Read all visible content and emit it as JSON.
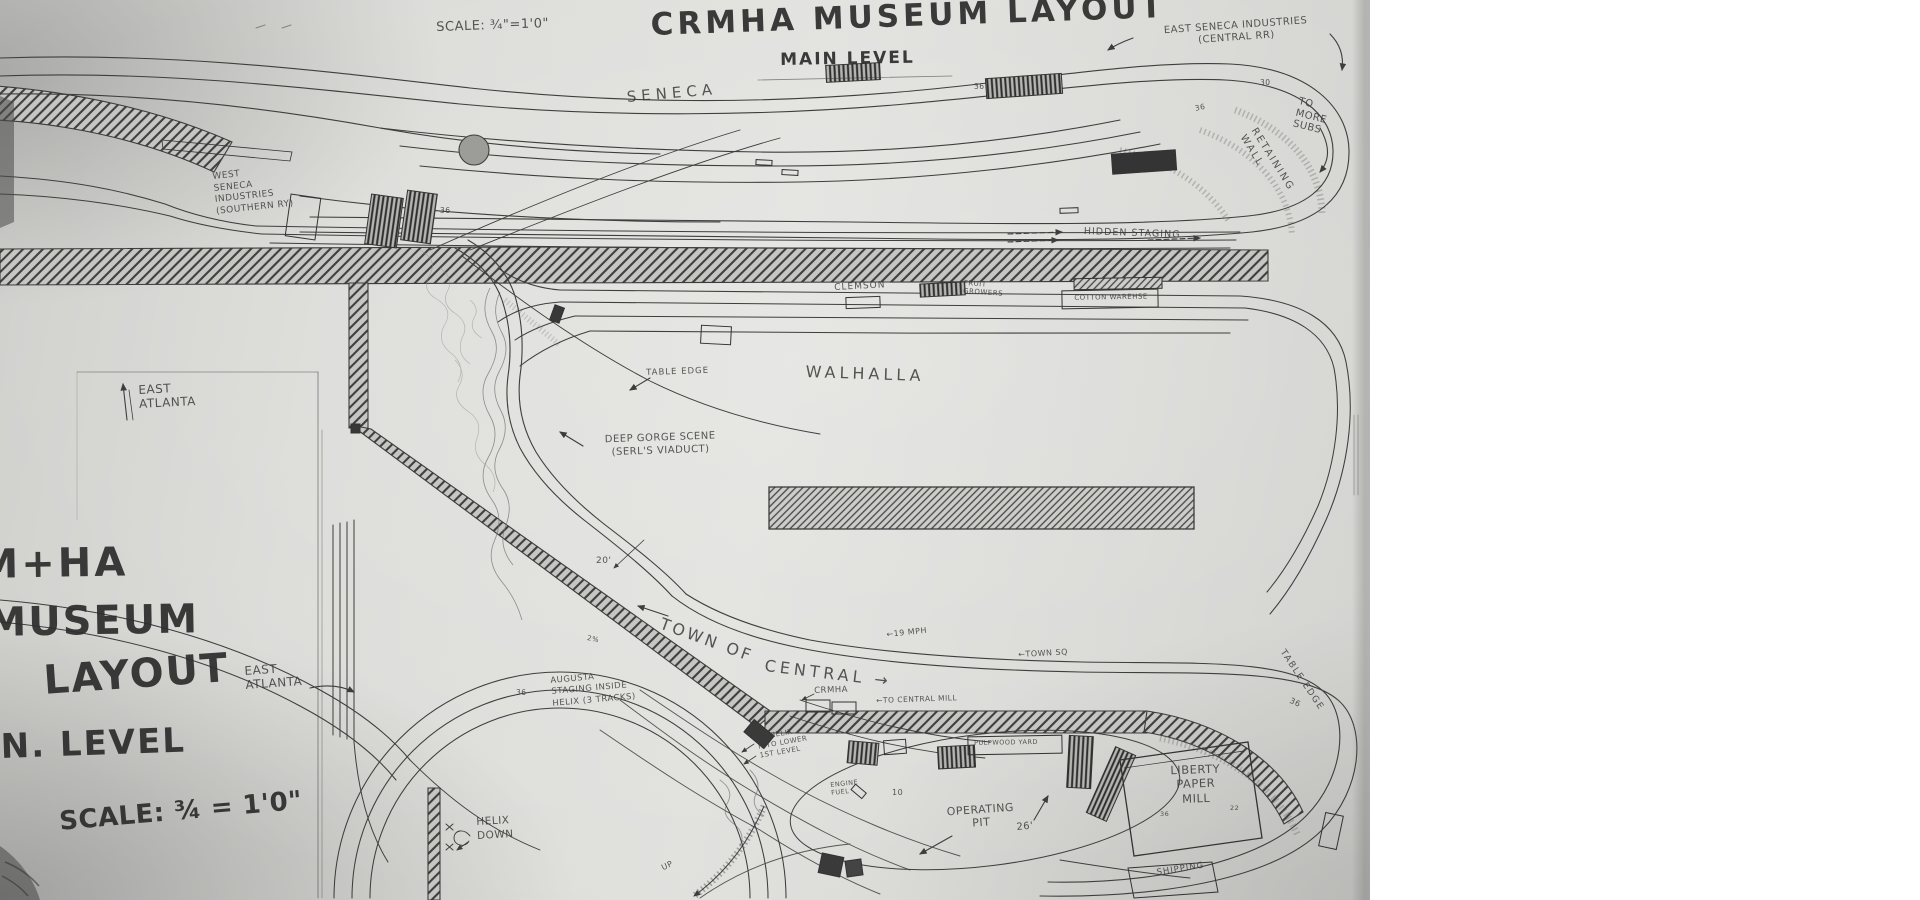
{
  "document": {
    "title": "CRMHA MUSEUM LAYOUT",
    "subtitle": "MAIN LEVEL",
    "scale_note": "SCALE: ¾\"=1'0\""
  },
  "colors": {
    "paper": "#d9d9d6",
    "pencil": "#3d3d3d",
    "background": "#ffffff"
  },
  "labels": [
    {
      "id": "scale-top",
      "text": "SCALE: ¾\"=1'0\"",
      "x": 436,
      "y": 20,
      "fs": 13,
      "rot": -2
    },
    {
      "id": "title",
      "text": "CRMHA MUSEUM LAYOUT",
      "x": 650,
      "y": 6,
      "fs": 31,
      "rot": -2,
      "ls": 4,
      "big": 1
    },
    {
      "id": "main-level",
      "text": "MAIN LEVEL",
      "x": 780,
      "y": 50,
      "fs": 17,
      "rot": -1,
      "ls": 2,
      "big": 1
    },
    {
      "id": "east-seneca-industries",
      "text": "EAST SENECA INDUSTRIES\n(CENTRAL RR)",
      "x": 1138,
      "y": 27,
      "fs": 10,
      "rot": -4,
      "w": 195,
      "al": "center",
      "lh": 1.15
    },
    {
      "id": "seneca",
      "text": "SENECA",
      "x": 626,
      "y": 88,
      "fs": 15,
      "rot": -5,
      "ls": 5
    },
    {
      "id": "west-seneca-industries",
      "text": "WEST\nSENECA\nINDUSTRIES\n(SOUTHERN RY)",
      "x": 212,
      "y": 172,
      "fs": 9,
      "rot": -6,
      "lh": 1.3
    },
    {
      "id": "to-more-subs",
      "text": "TO\nMORE\nSUBS",
      "x": 1300,
      "y": 96,
      "fs": 10,
      "rot": 14,
      "lh": 1.15
    },
    {
      "id": "retaining-wall",
      "text": "RETAINING WALL",
      "x": 1258,
      "y": 126,
      "fs": 10,
      "rot": 58,
      "ls": 2
    },
    {
      "id": "hidden-staging",
      "text": "HIDDEN STAGING",
      "x": 1084,
      "y": 226,
      "fs": 9.5,
      "rot": 2,
      "ls": 1
    },
    {
      "id": "clemson",
      "text": "CLEMSON",
      "x": 834,
      "y": 283,
      "fs": 9,
      "rot": -3,
      "ls": 1
    },
    {
      "id": "fruit-growers",
      "text": "FRUIT\nGROWERS",
      "x": 964,
      "y": 279,
      "fs": 7,
      "rot": 4,
      "lh": 1.2
    },
    {
      "id": "cotton-warehouse",
      "text": "COTTON WAREHSE",
      "x": 1066,
      "y": 294,
      "fs": 7,
      "rot": -1,
      "w": 90,
      "al": "center"
    },
    {
      "id": "walhalla",
      "text": "WALHALLA",
      "x": 806,
      "y": 362,
      "fs": 16,
      "rot": 2,
      "ls": 4
    },
    {
      "id": "table-edge-mid",
      "text": "TABLE EDGE",
      "x": 646,
      "y": 368,
      "fs": 8.5,
      "rot": -2,
      "ls": 1
    },
    {
      "id": "deep-gorge",
      "text": "DEEP GORGE SCENE\n(SERL'S VIADUCT)",
      "x": 585,
      "y": 434,
      "fs": 10,
      "rot": -2,
      "w": 150,
      "al": "center",
      "lh": 1.3
    },
    {
      "id": "east-atlanta-top",
      "text": "EAST\nATLANTA",
      "x": 138,
      "y": 383,
      "fs": 12,
      "rot": -3,
      "lh": 1.2
    },
    {
      "id": "big-crmha",
      "text": "M+HA",
      "x": -22,
      "y": 540,
      "fs": 40,
      "rot": -1,
      "big": 1,
      "ls": 3
    },
    {
      "id": "big-museum",
      "text": "MUSEUM",
      "x": -14,
      "y": 598,
      "fs": 40,
      "rot": -1,
      "big": 1,
      "ls": 2
    },
    {
      "id": "big-layout",
      "text": "LAYOUT",
      "x": 42,
      "y": 656,
      "fs": 40,
      "rot": -4,
      "big": 1,
      "ls": 2
    },
    {
      "id": "big-level",
      "text": "N. LEVEL",
      "x": 0,
      "y": 726,
      "fs": 34,
      "rot": -2,
      "big": 1,
      "ls": 2
    },
    {
      "id": "big-scale",
      "text": "SCALE: ¾ = 1'0\"",
      "x": 58,
      "y": 806,
      "fs": 26,
      "rot": -5,
      "big": 1
    },
    {
      "id": "east-atlanta-mid",
      "text": "EAST\nATLANTA",
      "x": 244,
      "y": 664,
      "fs": 12,
      "rot": -4,
      "lh": 1.2
    },
    {
      "id": "town-of",
      "text": "TOWN OF",
      "x": 664,
      "y": 614,
      "fs": 16,
      "rot": 20,
      "ls": 3
    },
    {
      "id": "central",
      "text": "CENTRAL →",
      "x": 766,
      "y": 656,
      "fs": 16,
      "rot": 7,
      "ls": 4
    },
    {
      "id": "mph-19",
      "text": "←19 MPH",
      "x": 886,
      "y": 630,
      "fs": 8,
      "rot": -6
    },
    {
      "id": "town-sq",
      "text": "←TOWN SQ",
      "x": 1018,
      "y": 650,
      "fs": 8,
      "rot": -3
    },
    {
      "id": "augusta-staging",
      "text": "AUGUSTA\nSTAGING INSIDE\nHELIX (3 TRACKS)",
      "x": 550,
      "y": 676,
      "fs": 8.5,
      "rot": -5,
      "lh": 1.35
    },
    {
      "id": "crmha-bldg",
      "text": "CRMHA",
      "x": 814,
      "y": 686,
      "fs": 8.5,
      "rot": -2
    },
    {
      "id": "to-central-mill",
      "text": "←TO CENTRAL MILL",
      "x": 876,
      "y": 696,
      "fs": 7.5,
      "rot": -2
    },
    {
      "id": "to-helix-lower",
      "text": "TO HELIX\nINTO LOWER\n1ST LEVEL",
      "x": 756,
      "y": 734,
      "fs": 7,
      "rot": -10,
      "lh": 1.3
    },
    {
      "id": "pulpwood",
      "text": "PULPWOOD YARD",
      "x": 974,
      "y": 739,
      "fs": 6.5,
      "rot": -1
    },
    {
      "id": "engine-fuel",
      "text": "ENGINE\nFUEL",
      "x": 830,
      "y": 782,
      "fs": 6.5,
      "rot": -6,
      "lh": 1.2
    },
    {
      "id": "operating-pit",
      "text": "OPERATING\nPIT",
      "x": 938,
      "y": 806,
      "fs": 11,
      "rot": -4,
      "w": 84,
      "al": "center",
      "lh": 1.2
    },
    {
      "id": "dim-26",
      "text": "26'",
      "x": 1016,
      "y": 822,
      "fs": 10,
      "rot": -5
    },
    {
      "id": "dim-10",
      "text": "10",
      "x": 892,
      "y": 788,
      "fs": 8
    },
    {
      "id": "liberty-paper-mill",
      "text": "LIBERTY\nPAPER\nMILL",
      "x": 1150,
      "y": 764,
      "fs": 11.5,
      "rot": -2,
      "w": 90,
      "al": "center",
      "lh": 1.25
    },
    {
      "id": "num-36-mill",
      "text": "36",
      "x": 1160,
      "y": 810,
      "fs": 6.5
    },
    {
      "id": "num-22-mill",
      "text": "22",
      "x": 1230,
      "y": 804,
      "fs": 6.5
    },
    {
      "id": "shipping",
      "text": "SHIPPING",
      "x": 1156,
      "y": 868,
      "fs": 8.5,
      "rot": -9,
      "ls": 1
    },
    {
      "id": "table-edge-right",
      "text": "TABLE EDGE",
      "x": 1286,
      "y": 648,
      "fs": 9,
      "rot": 56,
      "ls": 1.5
    },
    {
      "id": "num-36-right",
      "text": "36",
      "x": 1292,
      "y": 696,
      "fs": 8,
      "rot": 25
    },
    {
      "id": "helix-down",
      "text": "HELIX\nDOWN",
      "x": 476,
      "y": 816,
      "fs": 10.5,
      "rot": -3,
      "lh": 1.3
    },
    {
      "id": "up",
      "text": "UP",
      "x": 660,
      "y": 864,
      "fs": 8,
      "rot": -25
    },
    {
      "id": "num-36-a",
      "text": "36",
      "x": 440,
      "y": 206,
      "fs": 7.5
    },
    {
      "id": "num-36-b",
      "text": "36",
      "x": 974,
      "y": 82,
      "fs": 7.5
    },
    {
      "id": "num-36-c",
      "text": "36",
      "x": 1194,
      "y": 104,
      "fs": 7.5,
      "rot": -12
    },
    {
      "id": "num-30",
      "text": "30",
      "x": 1260,
      "y": 78,
      "fs": 7.5
    },
    {
      "id": "num-36-d",
      "text": "36",
      "x": 516,
      "y": 688,
      "fs": 7.5
    },
    {
      "id": "dim-20",
      "text": "20'",
      "x": 596,
      "y": 556,
      "fs": 9
    },
    {
      "id": "grade-2pct",
      "text": "2%",
      "x": 588,
      "y": 634,
      "fs": 7,
      "rot": 12
    }
  ]
}
